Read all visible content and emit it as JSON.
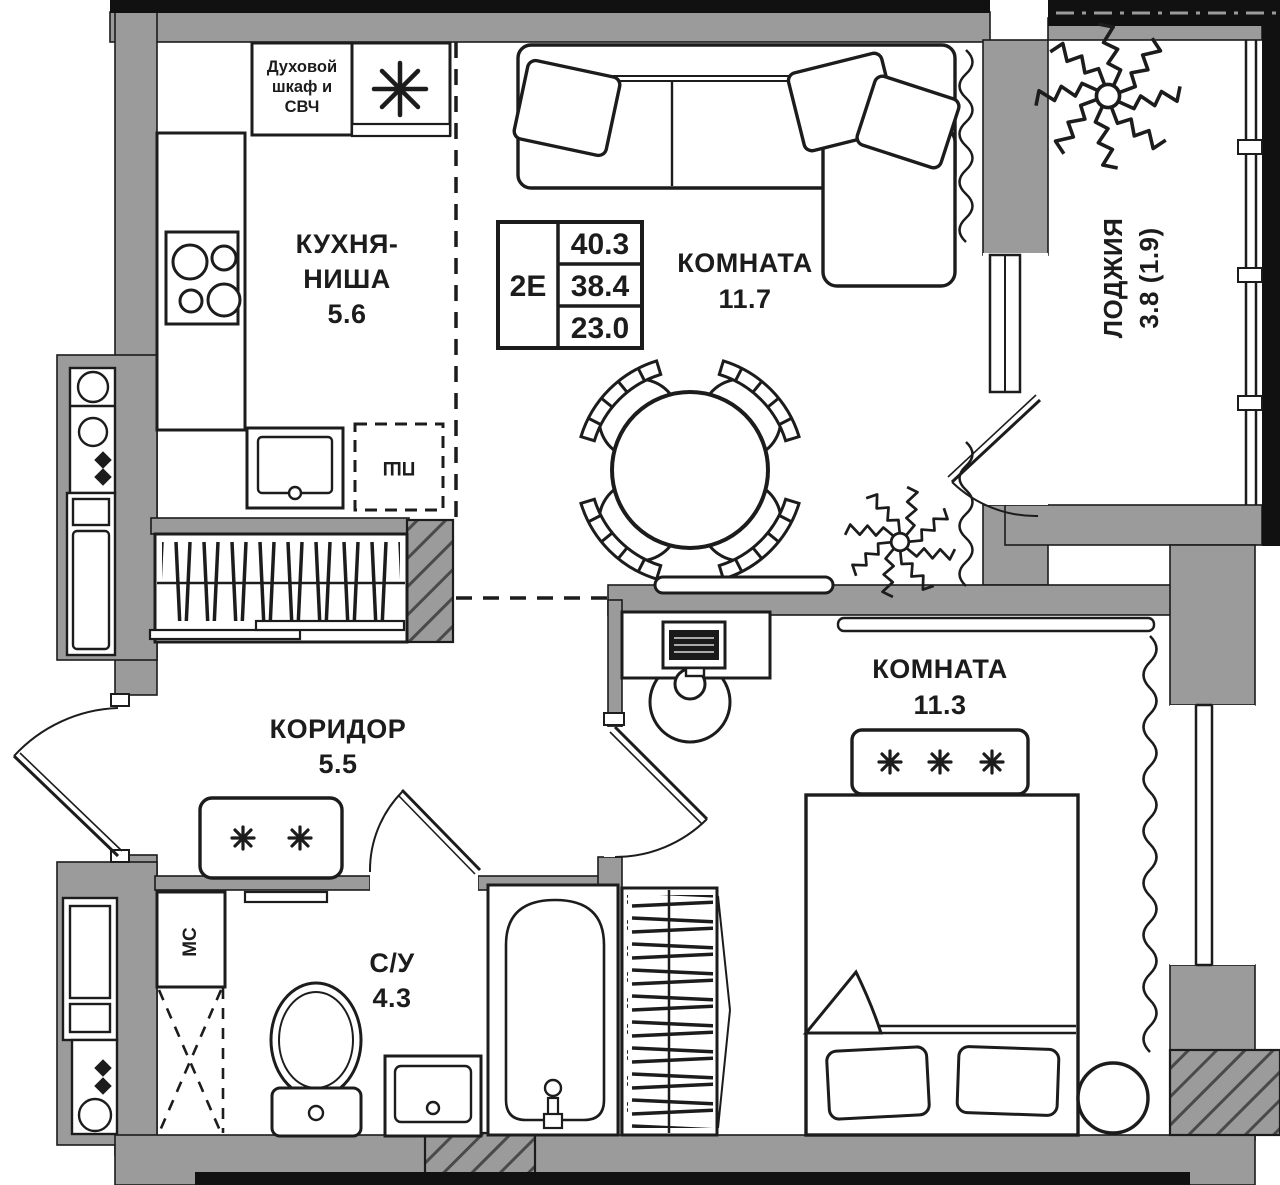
{
  "colors": {
    "wall_gray": "#9b9b9b",
    "line_black": "#1c1c1c",
    "outer_black": "#111111"
  },
  "unit_card": {
    "type": "2Е",
    "rows": [
      "40.3",
      "38.4",
      "23.0"
    ]
  },
  "rooms": {
    "kitchen": {
      "name_line1": "КУХНЯ-",
      "name_line2": "НИША",
      "area": "5.6"
    },
    "living": {
      "name": "КОМНАТА",
      "area": "11.7"
    },
    "bedroom": {
      "name": "КОМНАТА",
      "area": "11.3"
    },
    "corridor": {
      "name": "КОРИДОР",
      "area": "5.5"
    },
    "bathroom": {
      "name": "С/У",
      "area": "4.3"
    },
    "loggia": {
      "name": "ЛОДЖИЯ",
      "area": "3.8 (1.9)"
    }
  },
  "appliances": {
    "oven_line1": "Духовой",
    "oven_line2": "шкаф и",
    "oven_line3": "СВЧ",
    "dishwasher": "ПШ",
    "washer": "МС"
  }
}
